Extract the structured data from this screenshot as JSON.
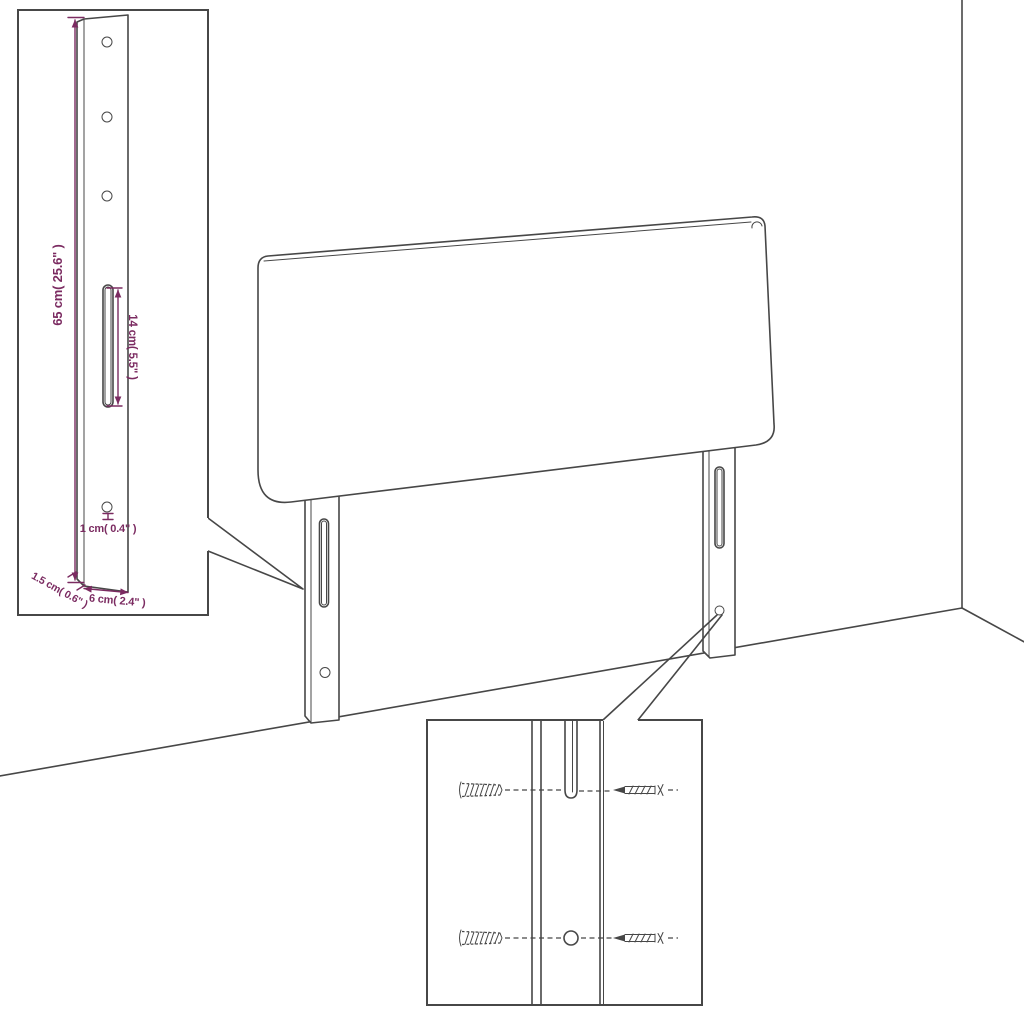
{
  "colors": {
    "line": "#474747",
    "dimension": "#7b2b61",
    "surface": "#ffffff"
  },
  "insets": {
    "leg_detail": {
      "leg_height_label": "65 cm( 25.6\" )",
      "slot_length_label": "14 cm( 5.5\" )",
      "hole_diameter_label": "1 cm( 0.4\" )",
      "leg_thickness_label": "1.5 cm( 0.6\" )",
      "leg_width_label": "6 cm( 2.4\" )"
    },
    "mounting_detail": {}
  }
}
